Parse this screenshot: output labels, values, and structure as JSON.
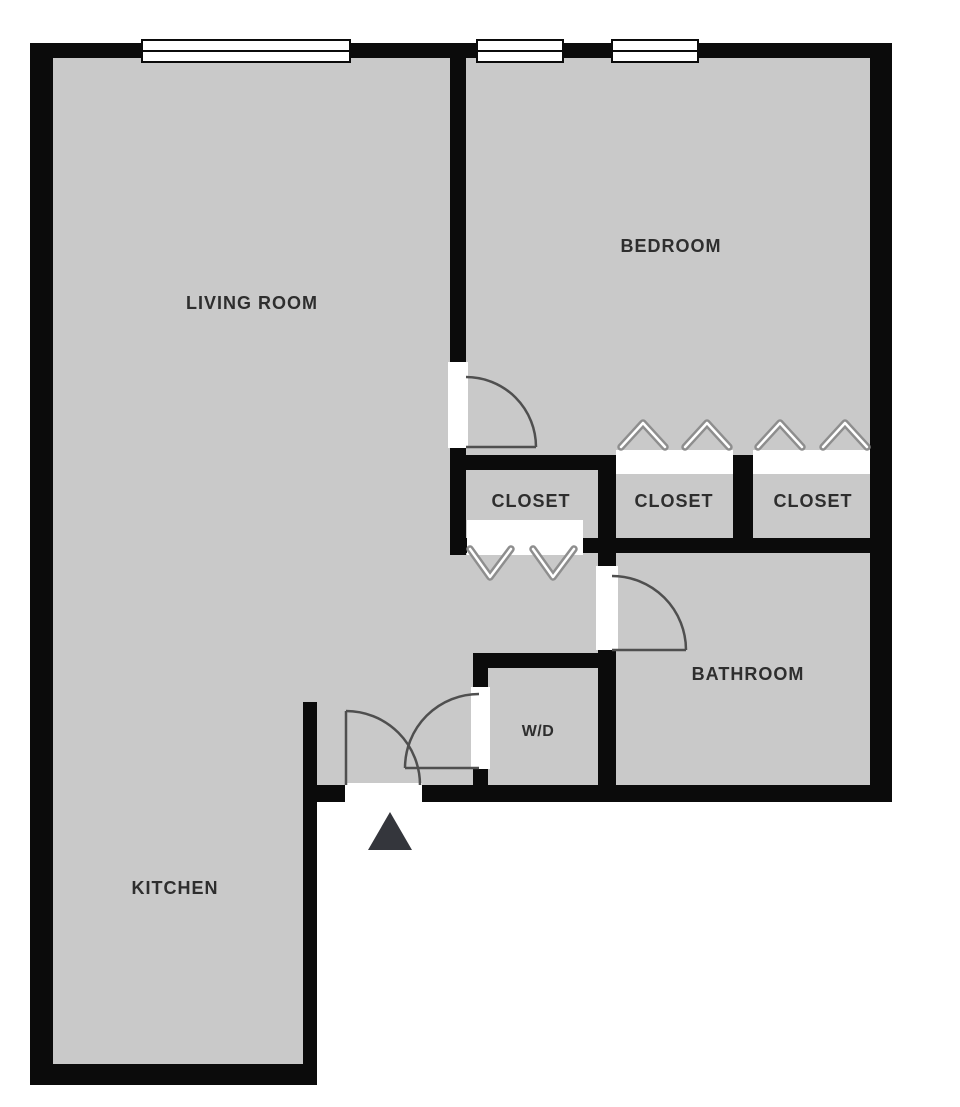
{
  "meta": {
    "type": "apartment-floor-plan",
    "background": "#ffffff"
  },
  "labels": {
    "living_room": "LIVING ROOM",
    "bedroom": "BEDROOM",
    "closet_hall": "CLOSET",
    "closet_bedroom_left": "CLOSET",
    "closet_bedroom_right": "CLOSET",
    "bathroom": "BATHROOM",
    "washer_dryer": "W/D",
    "kitchen": "KITCHEN"
  },
  "colors": {
    "floor": "#c9c9c9",
    "wall": "#0b0b0b",
    "opening": "#ffffff",
    "label_text": "#2e2e2e",
    "door_swing": "#4f4f4f",
    "closet_chevron": "#8e8e8e",
    "entrance_marker": "#34363c"
  },
  "icons": {
    "entrance_marker": "triangle-up-icon",
    "closet_bifold_doors": "chevron-icon",
    "window_symbol": "double-line-window-icon",
    "swing_doors": "quarter-arc-door-icon"
  }
}
